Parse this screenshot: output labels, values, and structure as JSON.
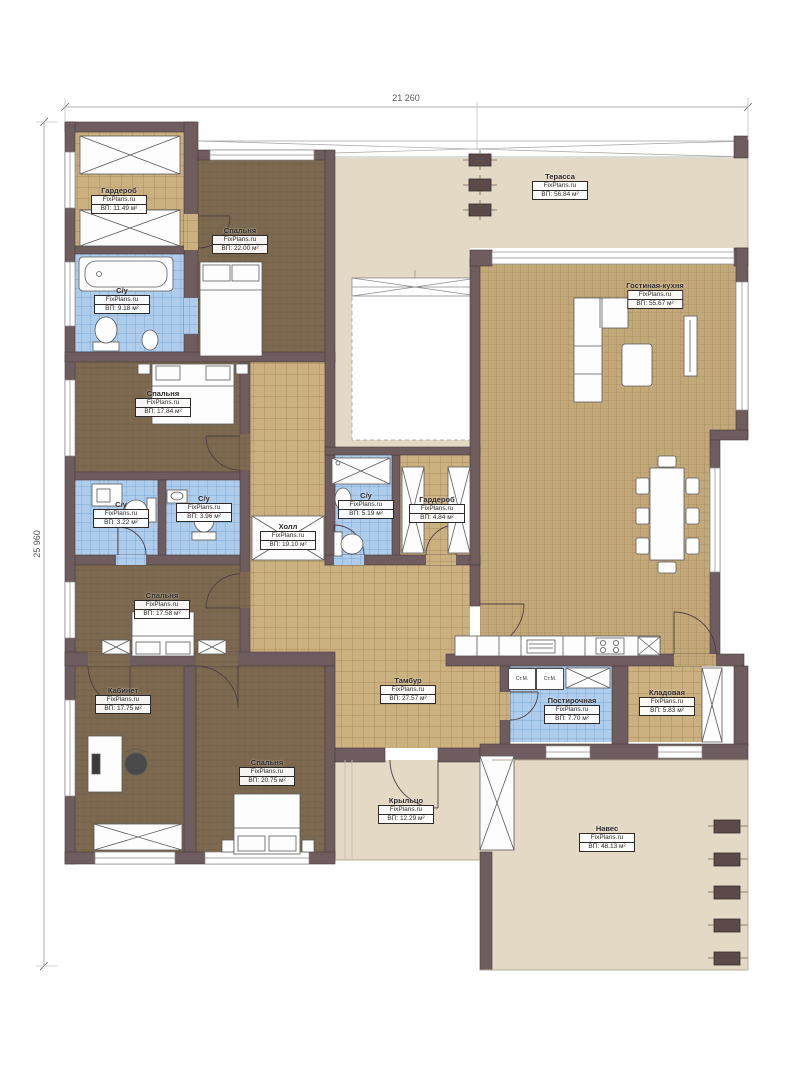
{
  "watermark": "FixPlans.ru",
  "dimensions": {
    "top": "21 260",
    "left": "25 960"
  },
  "rooms": [
    {
      "name": "Гардероб",
      "area": "ВП: 11.49 м²"
    },
    {
      "name": "С/у",
      "area": "ВП: 9.18 м²"
    },
    {
      "name": "Спальня",
      "area": "ВП: 22.00 м²"
    },
    {
      "name": "Терасса",
      "area": "ВП: 56.84 м²"
    },
    {
      "name": "Гостиная-кухня",
      "area": "ВП: 55.67 м²"
    },
    {
      "name": "Спальня",
      "area": "ВП: 17.84 м²"
    },
    {
      "name": "С/у",
      "area": "ВП: 3.22 м²"
    },
    {
      "name": "С/у",
      "area": "ВП: 3.96 м²"
    },
    {
      "name": "Холл",
      "area": "ВП: 19.10 м²"
    },
    {
      "name": "С/у",
      "area": "ВП: 5.19 м²"
    },
    {
      "name": "Гардероб",
      "area": "ВП: 4.84 м²"
    },
    {
      "name": "Спальня",
      "area": "ВП: 17.58 м²"
    },
    {
      "name": "Кабинет",
      "area": "ВП: 17.75 м²"
    },
    {
      "name": "Спальня",
      "area": "ВП: 20.75 м²"
    },
    {
      "name": "Тамбур",
      "area": "ВП: 27.57 м²"
    },
    {
      "name": "Постирочная",
      "area": "ВП: 7.70 м²"
    },
    {
      "name": "Кладовая",
      "area": "ВП: 5.83 м²"
    },
    {
      "name": "Крыльцо",
      "area": "ВП: 12.29 м²"
    },
    {
      "name": "Навес",
      "area": "ВП: 48.13 м²"
    }
  ],
  "appliances": [
    "Ст.М.",
    "Ст.М."
  ],
  "colors": {
    "wall": "#6f5c5e",
    "wood_floor": "#7b684e",
    "tan_tile": "#cbb080",
    "living_tile": "#c3a97a",
    "blue_tile": "#aecdec",
    "outdoor_floor": "#e4d9c5"
  }
}
